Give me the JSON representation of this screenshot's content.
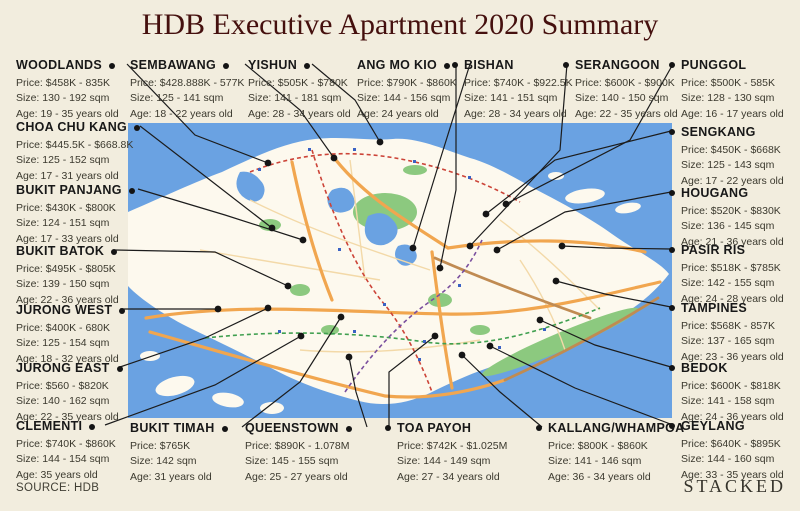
{
  "title": "HDB Executive Apartment 2020 Summary",
  "footer": {
    "source": "SOURCE: HDB",
    "brand": "STACKED"
  },
  "palette": {
    "background": "#f2edde",
    "title_text": "#45100e",
    "water": "#6aa2e2",
    "land": "#fdf9ee",
    "park": "#8cc97f",
    "road_primary": "#f1a64f",
    "road_secondary": "#c08b52",
    "mrt_red": "#cc4438",
    "mrt_green": "#3f9f4f",
    "mrt_purple": "#7a4f9e",
    "label_text": "#181818"
  },
  "towns": [
    {
      "name": "WOODLANDS",
      "price": "Price: $458K - 835K",
      "size": "Size: 130 - 192 sqm",
      "age": "Age: 19 - 35 years old"
    },
    {
      "name": "SEMBAWANG",
      "price": "Price: $428.888K - 577K",
      "size": "Size: 125 - 141 sqm",
      "age": "Age: 18 - 22 years old"
    },
    {
      "name": "YISHUN",
      "price": "Price: $505K - $780K",
      "size": "Size: 141 - 181 sqm",
      "age": "Age: 28 - 34 years old"
    },
    {
      "name": "ANG MO KIO",
      "price": "Price: $790K - $860K",
      "size": "Size: 144 - 156 sqm",
      "age": "Age: 24 years old"
    },
    {
      "name": "BISHAN",
      "price": "Price: $740K - $922.5K",
      "size": "Size: 141 - 151 sqm",
      "age": "Age: 28 - 34 years old"
    },
    {
      "name": "SERANGOON",
      "price": "Price: $600K - $900K",
      "size": "Size: 140 - 150 sqm",
      "age": "Age: 22 - 35 years old"
    },
    {
      "name": "PUNGGOL",
      "price": "Price: $500K - 585K",
      "size": "Size: 128 - 130 sqm",
      "age": "Age: 16 - 17 years old"
    },
    {
      "name": "CHOA CHU KANG",
      "price": "Price: $445.5K - $668.8K",
      "size": "Size: 125 - 152 sqm",
      "age": "Age: 17 - 31 years old"
    },
    {
      "name": "BUKIT PANJANG",
      "price": "Price: $430K - $800K",
      "size": "Size: 124 - 151 sqm",
      "age": "Age: 17 - 33 years old"
    },
    {
      "name": "BUKIT BATOK",
      "price": "Price: $495K - $805K",
      "size": "Size: 139 - 150 sqm",
      "age": "Age: 22 - 36 years old"
    },
    {
      "name": "JURONG WEST",
      "price": "Price: $400K - 680K",
      "size": "Size: 125 - 154 sqm",
      "age": "Age: 18 - 32 years old"
    },
    {
      "name": "JURONG EAST",
      "price": "Price: $560 - $820K",
      "size": "Size: 140 - 162 sqm",
      "age": "Age: 22 - 35 years old"
    },
    {
      "name": "CLEMENTI",
      "price": "Price: $740K - $860K",
      "size": "Size: 144 - 154 sqm",
      "age": "Age: 35 years old"
    },
    {
      "name": "SENGKANG",
      "price": "Price: $450K - $668K",
      "size": "Size: 125 - 143 sqm",
      "age": "Age: 17 - 22 years old"
    },
    {
      "name": "HOUGANG",
      "price": "Price: $520K - $830K",
      "size": "Size: 136 - 145 sqm",
      "age": "Age: 21 - 36 years old"
    },
    {
      "name": "PASIR RIS",
      "price": "Price: $518K - $785K",
      "size": "Size: 142 - 155 sqm",
      "age": "Age: 24 - 28 years old"
    },
    {
      "name": "TAMPINES",
      "price": "Price: $568K - 857K",
      "size": "Size: 137 - 165 sqm",
      "age": "Age: 23 - 36 years old"
    },
    {
      "name": "BEDOK",
      "price": "Price: $600K - $818K",
      "size": "Size: 141 - 158 sqm",
      "age": "Age: 24 - 36 years old"
    },
    {
      "name": "GEYLANG",
      "price": "Price: $640K - $895K",
      "size": "Size: 144 - 160 sqm",
      "age": "Age: 33 - 35 years old"
    },
    {
      "name": "BUKIT TIMAH",
      "price": "Price: $765K",
      "size": "Size: 142 sqm",
      "age": "Age: 31 years old"
    },
    {
      "name": "QUEENSTOWN",
      "price": "Price: $890K - 1.078M",
      "size": "Size: 145 - 155 sqm",
      "age": "Age: 25 - 27 years old"
    },
    {
      "name": "TOA PAYOH",
      "price": "Price: $742K - $1.025M",
      "size": "Size: 144 - 149 sqm",
      "age": "Age: 27 - 34 years old"
    },
    {
      "name": "KALLANG/WHAMPOA",
      "price": "Price: $800K - $860K",
      "size": "Size: 141 - 146 sqm",
      "age": "Age: 36 - 34 years old"
    }
  ]
}
